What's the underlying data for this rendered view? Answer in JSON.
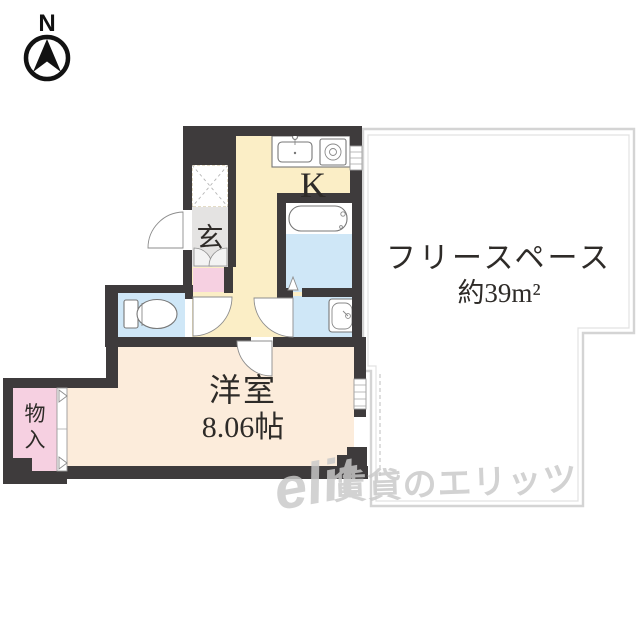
{
  "palette": {
    "wall": "#3e3b3c",
    "floor-cream": "#fbeec6",
    "floor-peach": "#fcecdb",
    "floor-blue": "#cfe7f7",
    "floor-gray": "#e4e3e2",
    "floor-pink": "#f6d0e1"
  },
  "compass": {
    "label": "N"
  },
  "rooms": {
    "kitchen": {
      "label": "K"
    },
    "genkan": {
      "label": "玄"
    },
    "western": {
      "label": "洋室",
      "size": "8.06帖"
    },
    "free_space": {
      "label": "フリースペース",
      "size": "約39m²"
    },
    "storage": {
      "label": "物入",
      "char1": "物",
      "char2": "入"
    }
  },
  "watermark": {
    "logo": "elit",
    "text": "賃貸のエリッツ"
  }
}
